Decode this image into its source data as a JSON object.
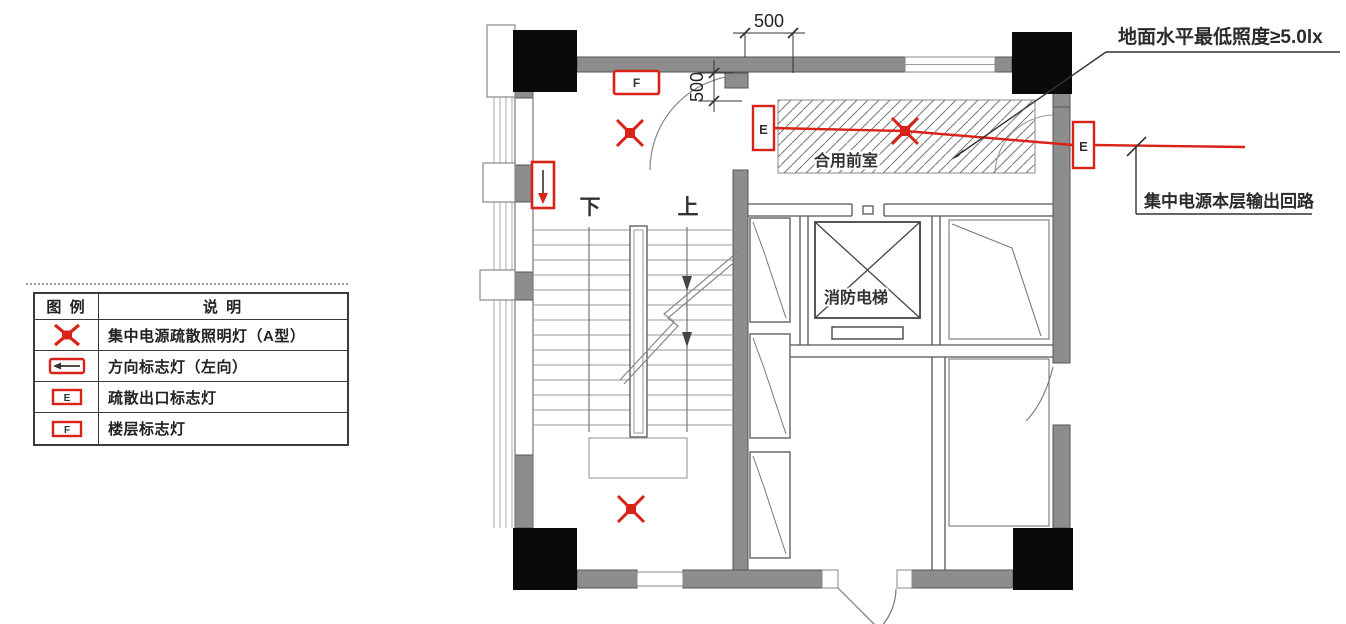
{
  "annotations": {
    "illuminance": "地面水平最低照度≥5.0lx",
    "circuit": "集中电源本层输出回路"
  },
  "plan": {
    "lobby_label": "合用前室",
    "elevator_label": "消防电梯",
    "stair_down": "下",
    "stair_up": "上",
    "dim_top": "500",
    "dim_side": "500",
    "exit_letter_left": "E",
    "exit_letter_right": "E",
    "floor_letter": "F"
  },
  "legend": {
    "header_symbol": "图 例",
    "header_desc": "说 明",
    "rows": [
      {
        "letter": "",
        "desc": "集中电源疏散照明灯（A型）"
      },
      {
        "letter": "",
        "desc": "方向标志灯（左向）"
      },
      {
        "letter": "E",
        "desc": "疏散出口标志灯"
      },
      {
        "letter": "F",
        "desc": "楼层标志灯"
      }
    ]
  },
  "colors": {
    "red": "#d92318",
    "wall": "#8d8d8d",
    "column": "#0a0a0a"
  }
}
